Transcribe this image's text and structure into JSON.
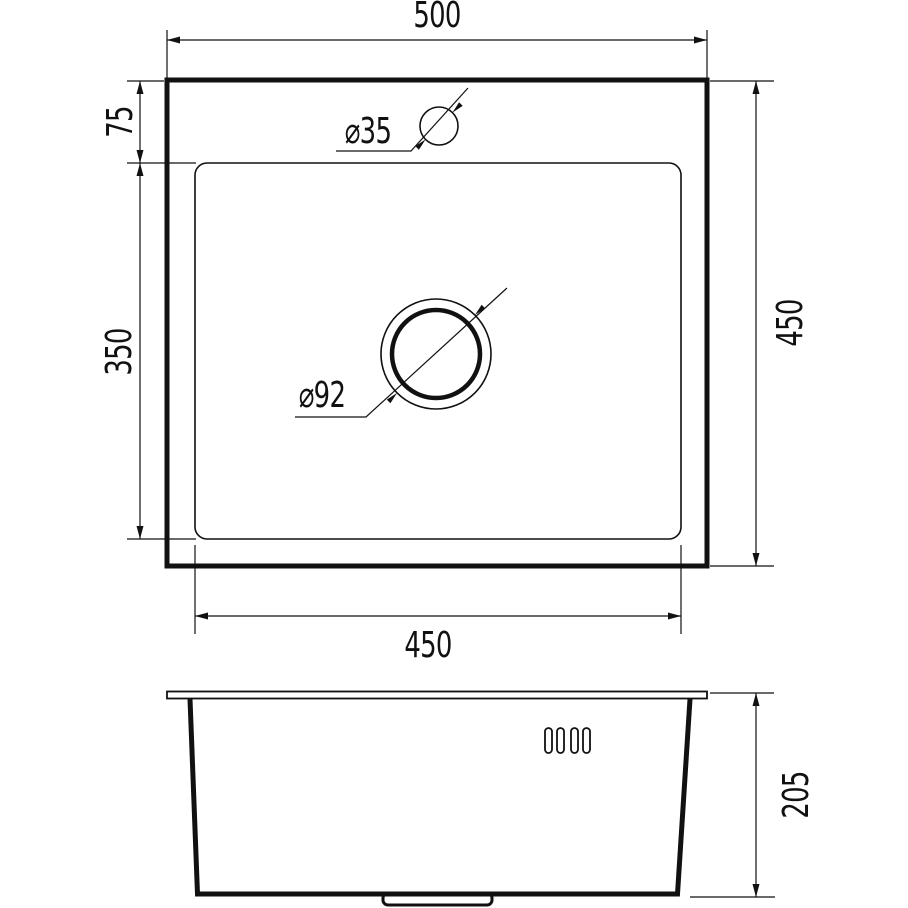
{
  "colors": {
    "line": "#111111",
    "background": "#ffffff"
  },
  "top_view": {
    "overall_width_label": "500",
    "overall_depth_label": "450",
    "faucet_offset_label": "75",
    "bowl_depth_label": "350",
    "bowl_width_label": "450",
    "faucet_hole_label": "⌀35",
    "drain_hole_label": "⌀92"
  },
  "side_view": {
    "height_label": "205"
  }
}
